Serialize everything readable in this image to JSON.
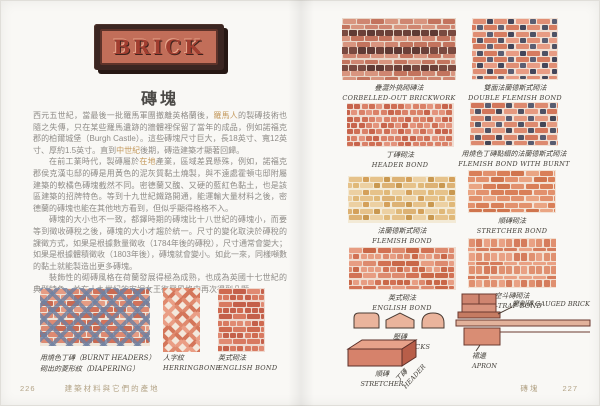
{
  "book": {
    "sign_text": "BRICK",
    "title": "磚塊",
    "footer": {
      "left_page_number": "226",
      "left_section": "建築材料與它們的產地",
      "right_section": "磚塊",
      "right_page_number": "227"
    }
  },
  "body": {
    "paragraphs": [
      [
        {
          "text": "西元五世紀，當最後一批羅馬軍團撤離英格蘭後，"
        },
        {
          "text": "羅馬人",
          "hl": true
        },
        {
          "text": "的製磚技術也隨之失傳，只在某些羅馬遺跡的牆體裡保留了當年的成品，例如諾福克郡的柏爾城堡（Burgh Castle）。這些磚塊尺寸巨大，長18英寸、寬12英寸、厚約1.5英寸。直到"
        },
        {
          "text": "中世紀",
          "hl": true
        },
        {
          "text": "後期，磚造建築才顯著回歸。"
        }
      ],
      [
        {
          "text": "在前工業時代，製磚屬於"
        },
        {
          "text": "在地",
          "hl": true
        },
        {
          "text": "產業，區域差異懸殊，例如，諾福克郡侯克漢屯邸的磚是用黃色的泥灰質黏土燒製，與不遠處霍頓屯邸附屬建築的軟橘色磚塊截然不同。密德蘭又醜、又硬的藍紅色黏土，也是該區建築的招牌特色。等到十九世紀鐵路開通，能運輸大量材料之後，密德蘭的磚塊也能在其他地方看到，但似乎顯得格格不入。"
        }
      ],
      [
        {
          "text": "磚塊的大小也不一致，都鐸時期的磚塊比十八世紀的磚塊小，而要等到徵收磚稅之後，磚塊的大小才趨於統一。尺寸的變化取決於磚稅的課徵方式，如果是根據數量徵收（1784年後的磚稅），尺寸通常會變大；如果是根據體積徵收（1803年後），磚塊就會變小。如此一來，同樣噸數的黏土就能製造出更多磚塊。"
        }
      ],
      [
        {
          "text": "裝飾性的砌磚風格在荷蘭發展得極為成熟，也成為英國十七世紀的典型特色，並在十九世紀的安妮女王復興風格中再次得到凸顯。"
        }
      ]
    ]
  },
  "left_figures": [
    {
      "line1": "用燒色丁磚（BURNT HEADERS）",
      "line2": "砌出的菱形紋（DIAPERING）",
      "pattern": "diaper"
    },
    {
      "zh": "人字紋",
      "en": "HERRINGBONE",
      "pattern": "herringbone"
    },
    {
      "zh": "英式砌法",
      "en": "ENGLISH BOND",
      "pattern": "english_red"
    }
  ],
  "right_figures": [
    {
      "zh": "疊澀外挑砌磚法",
      "en": "CORBELLED-OUT BRICKWORK",
      "pattern": "corbelled"
    },
    {
      "zh": "雙面法蘭德斯式砌法",
      "en": "DOUBLE FLEMISH BOND",
      "pattern": "flemish_double"
    },
    {
      "zh": "丁磚砌法",
      "en": "HEADER BOND",
      "pattern": "header"
    },
    {
      "zh": "用燒色丁磚點綴的法蘭德斯式砌法",
      "en": "FLEMISH BOND WITH BURNT HEADER",
      "pattern": "flemish_burnt"
    },
    {
      "zh": "法蘭德斯式砌法",
      "en": "FLEMISH BOND",
      "pattern": "flemish_yellow"
    },
    {
      "zh": "順磚砌法",
      "en": "STRETCHER BOND",
      "pattern": "stretcher"
    },
    {
      "zh": "英式砌法",
      "en": "ENGLISH BOND",
      "pattern": "english"
    },
    {
      "zh": "空斗磚砌法",
      "en": "RAT-TRAP BOND",
      "pattern": "rattrap"
    }
  ],
  "details": {
    "coping": {
      "zh": "壓磚",
      "en": "COPING BRICKS"
    },
    "brick3d": {
      "stretcher_zh": "順磚",
      "stretcher_en": "STRETCHER",
      "header_zh": "丁磚",
      "header_en": "HEADER"
    },
    "gauged": {
      "zh": "磨削磚",
      "en": "GAUGED BRICK"
    },
    "apron": {
      "zh": "裙邊",
      "en": "APRON"
    }
  },
  "colors": {
    "highlight_text": "#c49a5e",
    "footer_text": "#b3a386",
    "sign_plaque": "#3b2622",
    "sign_panel": "#c26e59",
    "sign_letters": "#a23e30"
  },
  "patterns": {
    "diaper": {
      "type": "diaper",
      "mortar": "#efe5d9",
      "base": [
        "#dd8a72",
        "#d3735b",
        "#e59c84",
        "#c96a52"
      ],
      "lattice": "#6f81a1"
    },
    "herringbone": {
      "type": "herringbone",
      "mortar": "#f3e8dc",
      "base": [
        "#e08a6e",
        "#d4765a",
        "#ea9e85"
      ]
    },
    "english_red": {
      "type": "english",
      "mortar": "#eed9cf",
      "base": [
        "#d87a61",
        "#cf6a50",
        "#e08a72",
        "#c4604a"
      ]
    },
    "corbelled": {
      "type": "corbelled",
      "mortar": "#e9d7c9",
      "base": [
        "#cf8671",
        "#c3745e",
        "#d8957f"
      ],
      "dark": [
        "#6b4038",
        "#7a4a40",
        "#5f3a34"
      ]
    },
    "flemish_double": {
      "type": "flemish",
      "mortar": "#f1dfd3",
      "base": [
        "#e08e74",
        "#d67c60",
        "#e89c84"
      ],
      "dark": [
        "#4e5264",
        "#5a5e72",
        "#43465a"
      ]
    },
    "header": {
      "type": "header",
      "mortar": "#f0ddd2",
      "base": [
        "#da8168",
        "#cf6f55",
        "#e3937c",
        "#c7644c"
      ]
    },
    "flemish_burnt": {
      "type": "flemish",
      "mortar": "#f1dfd3",
      "base": [
        "#dd8a6f",
        "#d3765a",
        "#e59a80"
      ],
      "dark": [
        "#4e5264",
        "#585c70",
        "#434656"
      ]
    },
    "flemish_yellow": {
      "type": "flemish",
      "mortar": "#f3ead6",
      "base": [
        "#e6c28a",
        "#ecd0a2",
        "#ddb274"
      ],
      "dark": [
        "#d4a05a",
        "#e0b878",
        "#c99850"
      ]
    },
    "stretcher": {
      "type": "stretcher",
      "mortar": "#f3e3d6",
      "base": [
        "#e2916d",
        "#d97f58",
        "#eaa583",
        "#d0754e"
      ]
    },
    "english": {
      "type": "english",
      "mortar": "#f0dccf",
      "base": [
        "#dd8a6e",
        "#d27254",
        "#e79d82",
        "#c96848"
      ]
    },
    "rattrap": {
      "type": "rattrap",
      "mortar": "#f2e0d2",
      "base": [
        "#e09070",
        "#d57c5c",
        "#e9a184"
      ]
    }
  }
}
